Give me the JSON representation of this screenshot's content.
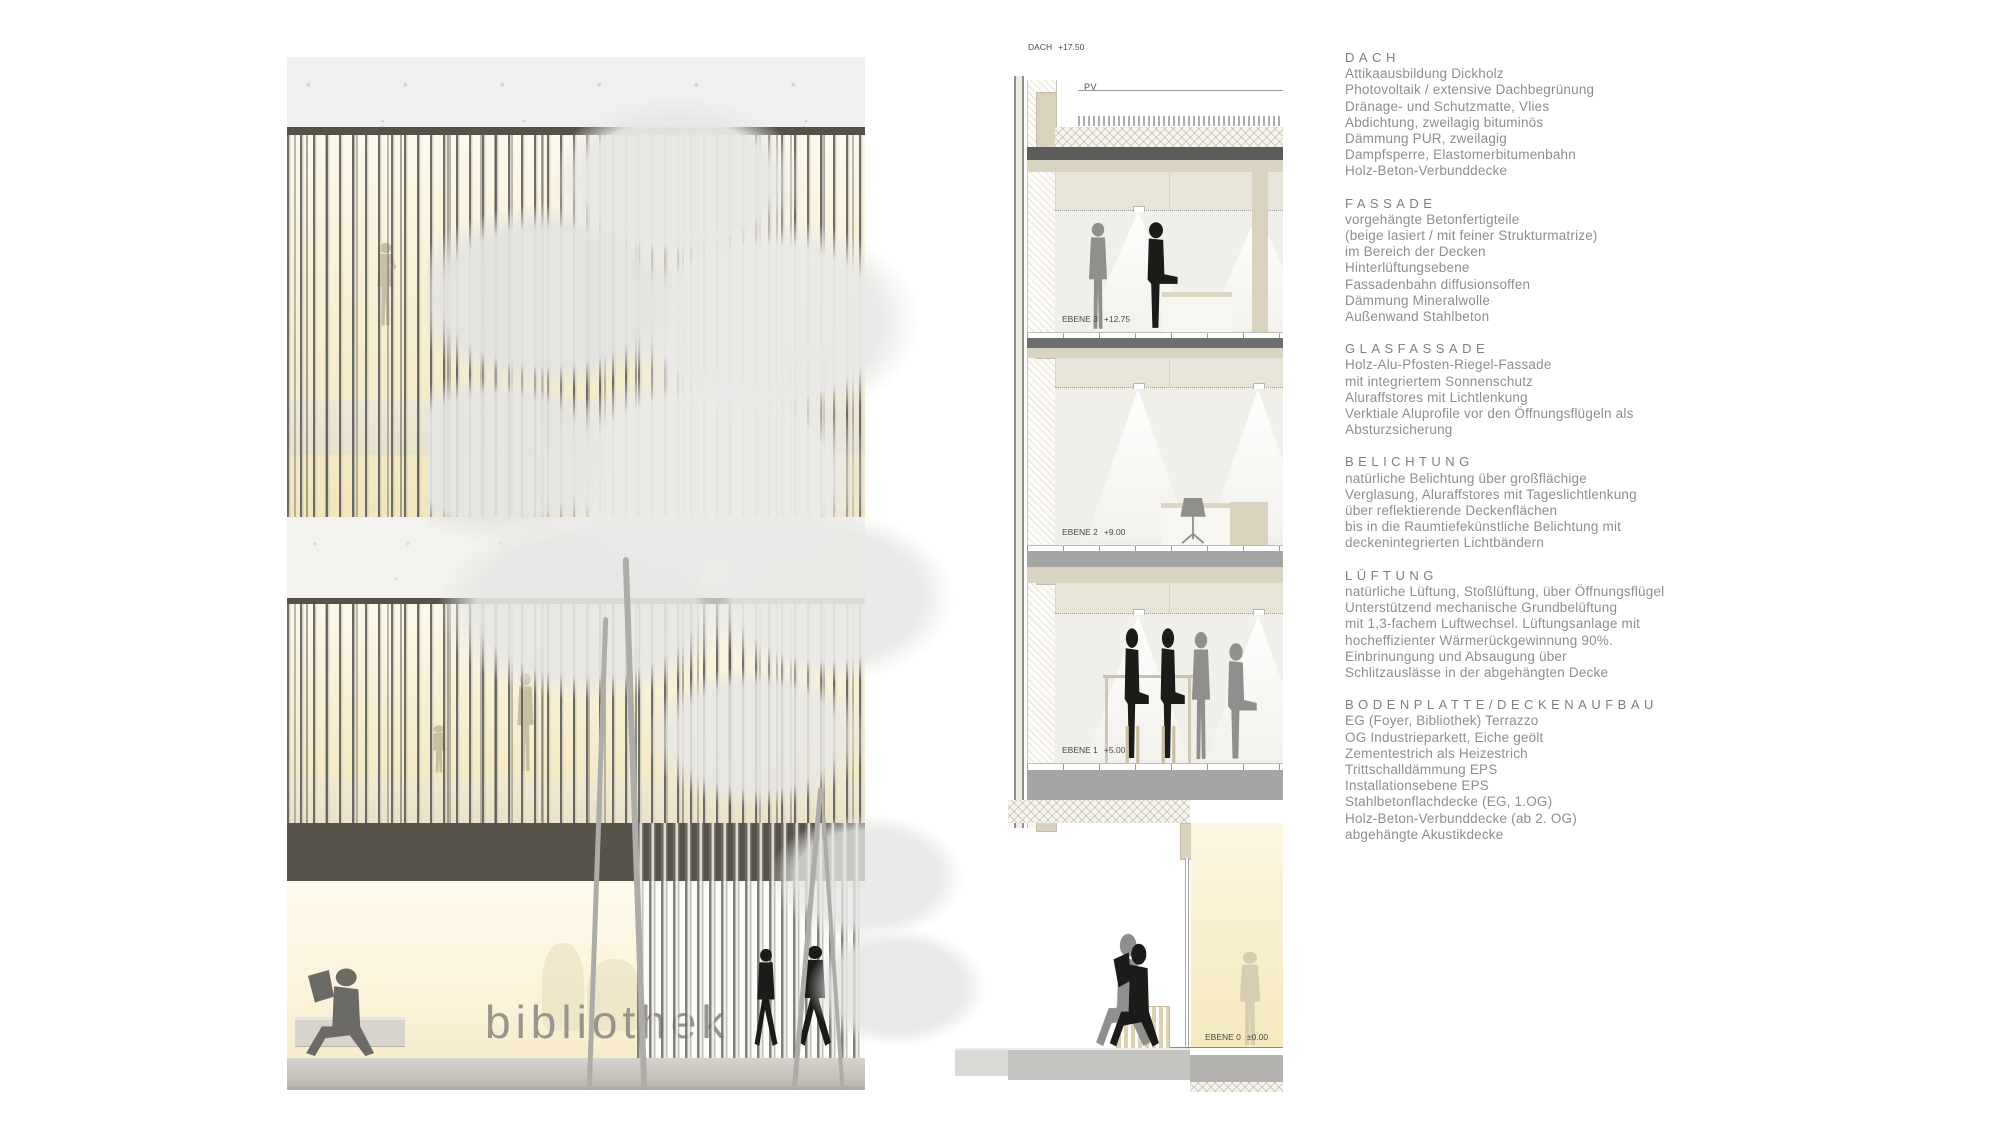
{
  "elevation": {
    "sign": "bibliothek"
  },
  "section": {
    "pv_label": "PV",
    "levels": [
      {
        "name": "DACH",
        "elev": "+17.50"
      },
      {
        "name": "EBENE 3",
        "elev": "+12.75"
      },
      {
        "name": "EBENE 2",
        "elev": "+9.00"
      },
      {
        "name": "EBENE 1",
        "elev": "+5.00"
      },
      {
        "name": "EBENE 0",
        "elev": "±0.00"
      }
    ]
  },
  "notes": {
    "sections": [
      {
        "title": "DACH",
        "lines": [
          "Attikaausbildung Dickholz",
          "Photovoltaik / extensive Dachbegrünung",
          "Dränage- und Schutzmatte, Vlies",
          "Abdichtung, zweilagig bituminös",
          "Dämmung PUR, zweilagig",
          "Dampfsperre, Elastomerbitumenbahn",
          "Holz-Beton-Verbunddecke"
        ]
      },
      {
        "title": "FASSADE",
        "lines": [
          "vorgehängte Betonfertigteile",
          "(beige lasiert / mit feiner Strukturmatrize)",
          "im Bereich der Decken",
          "Hinterlüftungsebene",
          "Fassadenbahn diffusionsoffen",
          "Dämmung Mineralwolle",
          "Außenwand Stahlbeton"
        ]
      },
      {
        "title": "GLASFASSADE",
        "lines": [
          "Holz-Alu-Pfosten-Riegel-Fassade",
          "mit integriertem Sonnenschutz",
          "Aluraffstores mit Lichtlenkung",
          "Verktiale Aluprofile vor den Öffnungsflügeln als",
          "Absturzsicherung"
        ]
      },
      {
        "title": "BELICHTUNG",
        "lines": [
          "natürliche Belichtung über großflächige",
          "Verglasung, Aluraffstores mit Tageslichtlenkung",
          "über reflektierende Deckenflächen",
          "bis in die Raumtiefekünstliche Belichtung mit",
          "deckenintegrierten Lichtbändern"
        ]
      },
      {
        "title": "LÜFTUNG",
        "lines": [
          "natürliche Lüftung, Stoßlüftung, über Öffnungsflügel",
          "Unterstützend mechanische Grundbelüftung",
          "mit 1,3-fachem Luftwechsel. Lüftungsanlage mit",
          "hocheffizienter Wärmerückgewinnung 90%.",
          "Einbrinungung und Absaugung über",
          "Schlitzauslässe in der abgehängten Decke"
        ]
      },
      {
        "title": "BODENPLATTE/DECKENAUFBAU",
        "lines": [
          "EG (Foyer, Bibliothek) Terrazzo",
          "OG Industrieparkett, Eiche geölt",
          "Zementestrich als Heizestrich",
          "Trittschalldämmung EPS",
          "Installationsebene EPS",
          "Stahlbetonflachdecke (EG, 1.OG)",
          "Holz-Beton-Verbunddecke (ab 2. OG)",
          "abgehängte Akustikdecke"
        ]
      }
    ]
  },
  "colors": {
    "glass_warm": "#f7edcd",
    "band_dark": "#57534b",
    "concrete": "#f0f0f1",
    "slab_gray": "#a5a5a3",
    "beige": "#d9d2bf",
    "text_gray": "#8e8e8e",
    "sign_gray": "#98958f"
  }
}
